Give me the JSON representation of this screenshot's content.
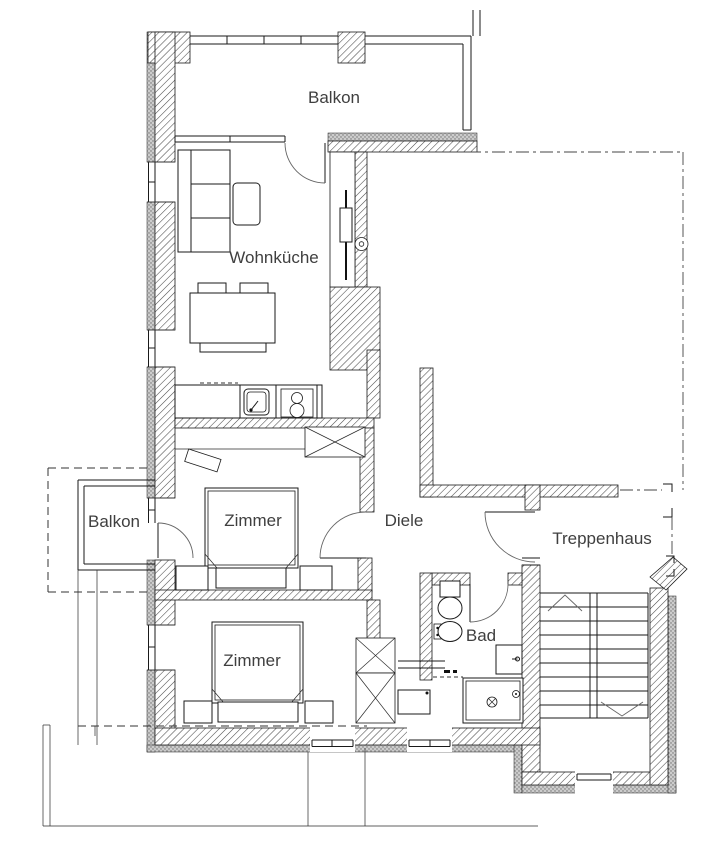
{
  "plan": {
    "type": "apartment-floor-plan",
    "units_visible_text_only": true
  },
  "rooms": {
    "balkon_top": {
      "label": "Balkon"
    },
    "wohnkueche": {
      "label": "Wohnküche"
    },
    "balkon_left": {
      "label": "Balkon"
    },
    "zimmer_1": {
      "label": "Zimmer"
    },
    "diele": {
      "label": "Diele"
    },
    "treppenhaus": {
      "label": "Treppenhaus"
    },
    "zimmer_2": {
      "label": "Zimmer"
    },
    "bad": {
      "label": "Bad"
    }
  },
  "colors": {
    "background": "#ffffff",
    "wall_hatch_line": "#4a4a4a",
    "insulation_gray": "#c9c9c9",
    "drawing_line": "#1a1a1a",
    "label_text": "#3f3f3f"
  }
}
